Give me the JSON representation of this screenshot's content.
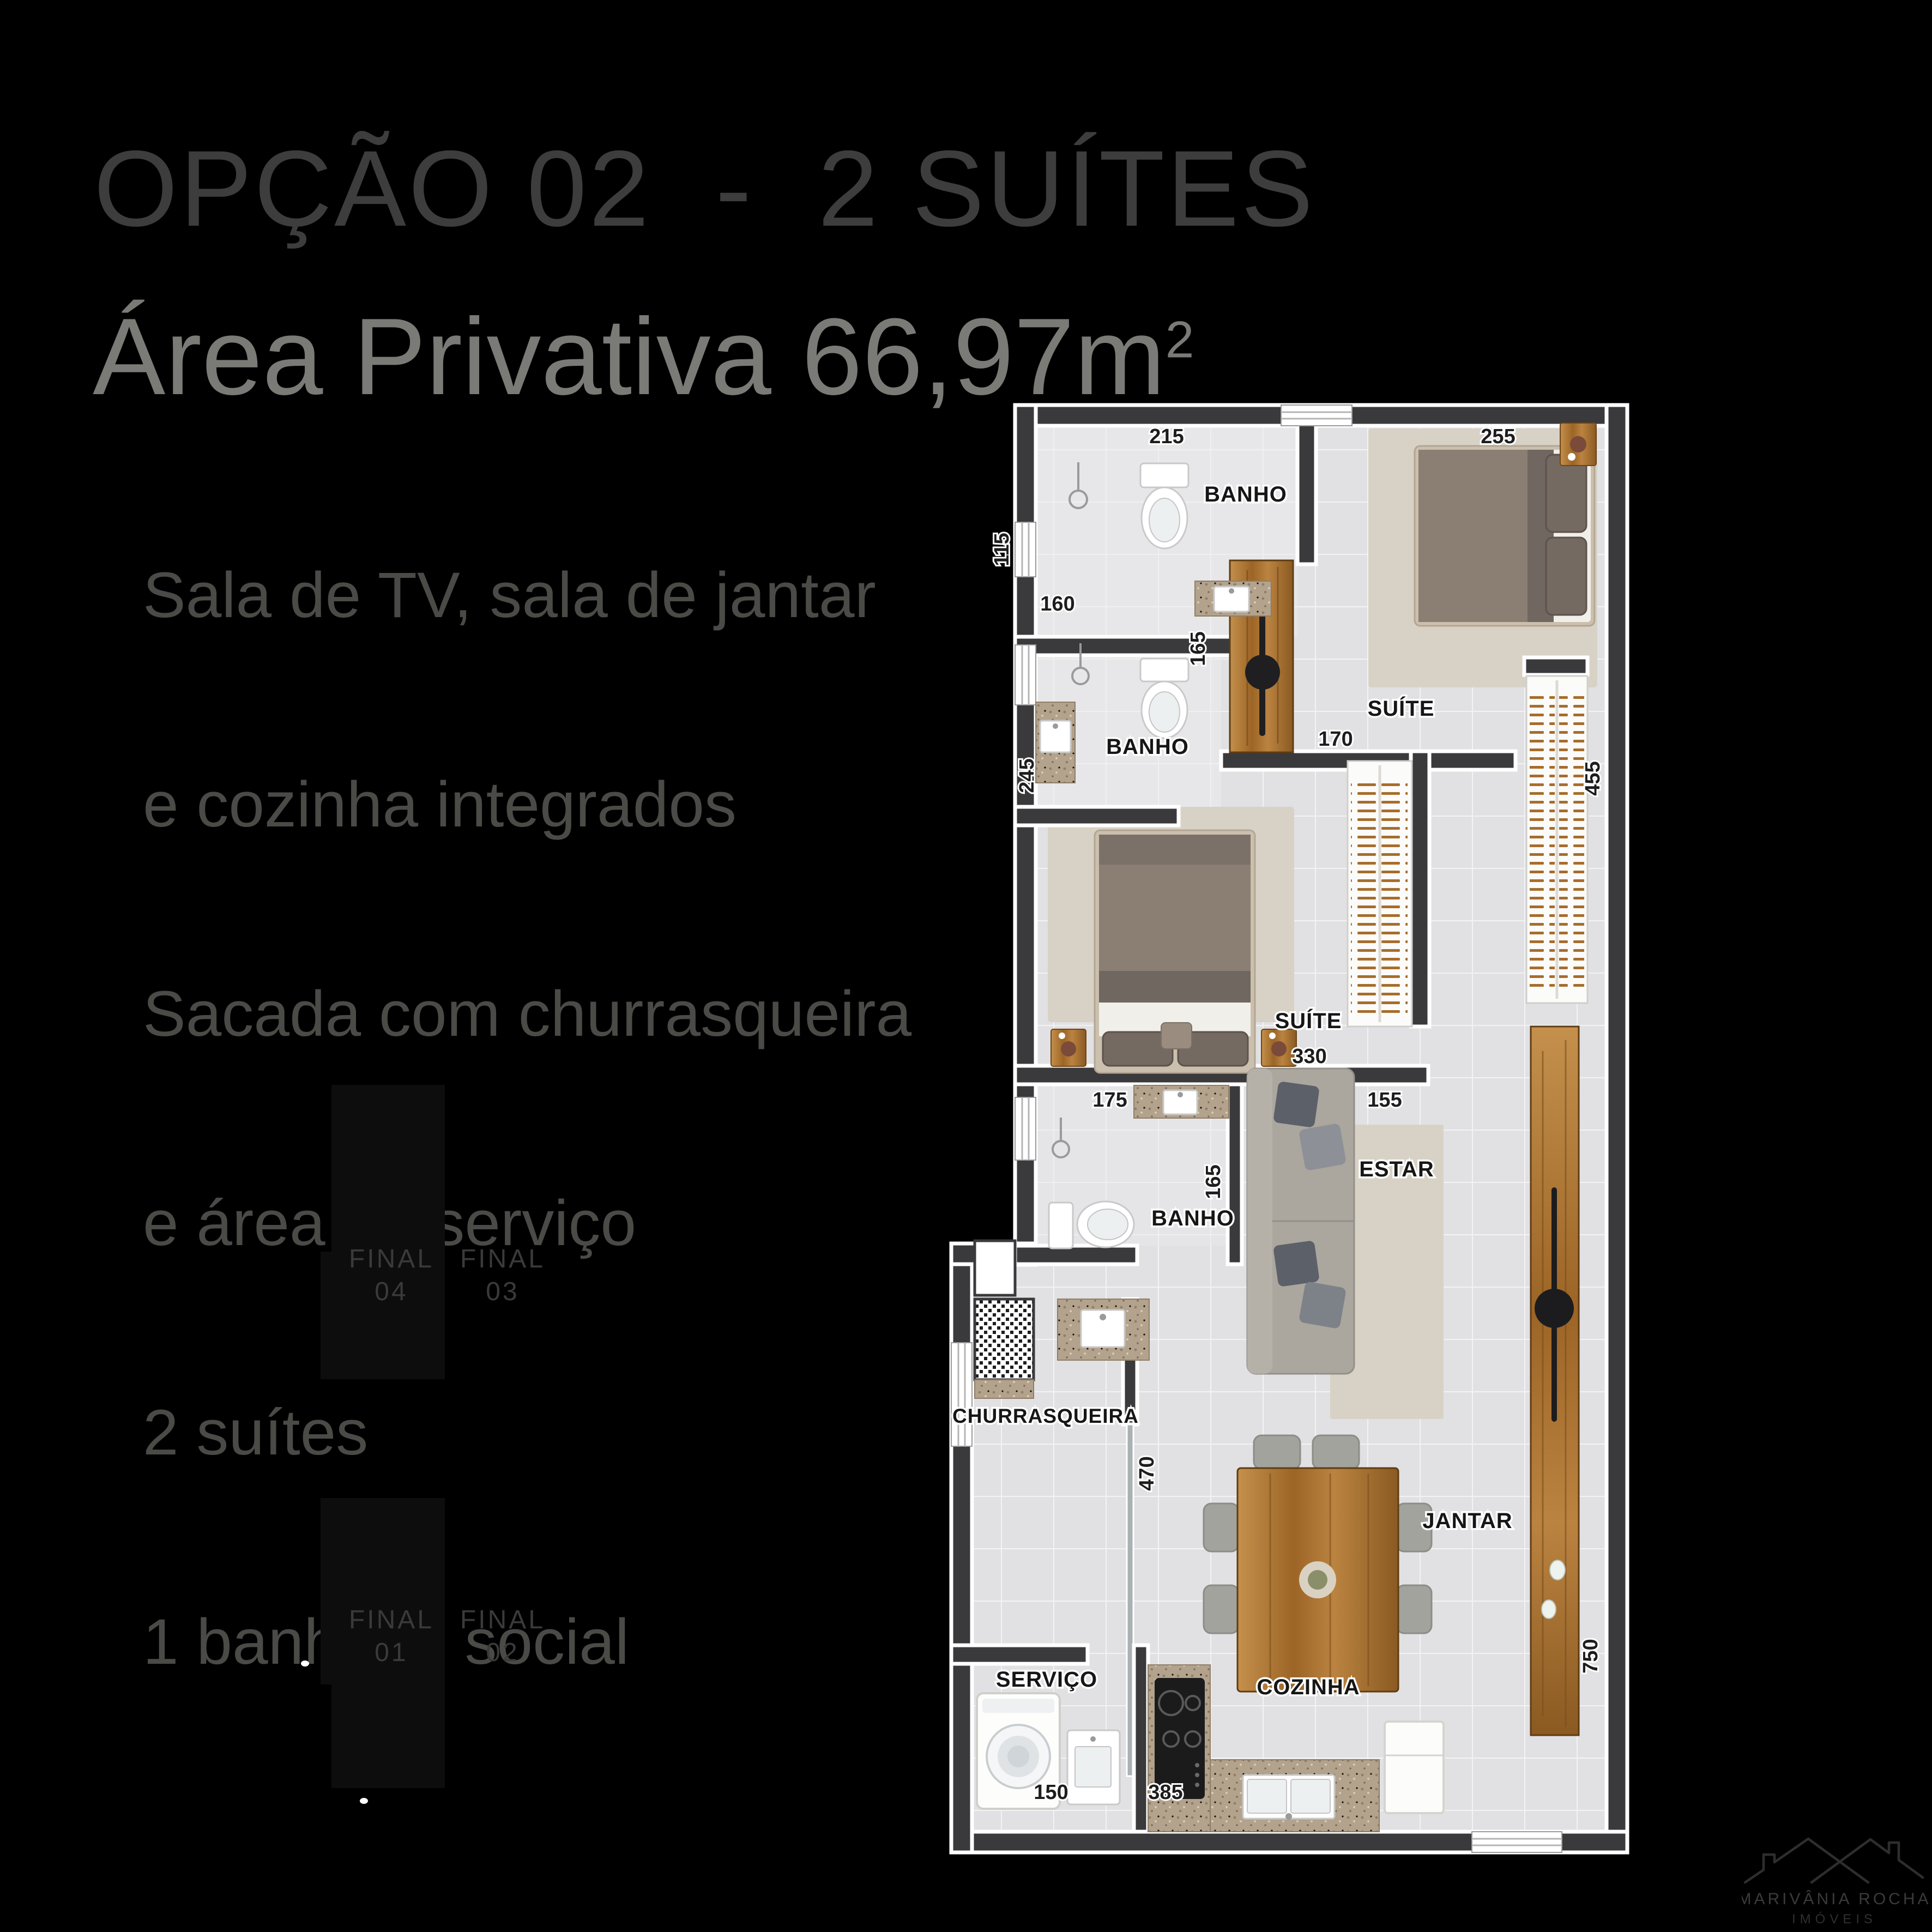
{
  "title": "OPÇÃO 02  -  2 SUÍTES",
  "area": {
    "label": "Área Privativa 66,97m",
    "sup": "2"
  },
  "features": [
    "Sala de TV, sala de jantar",
    "e cozinha integrados",
    "Sacada com churrasqueira",
    "e área de serviço",
    "2 suítes",
    "1 banheiro social"
  ],
  "plan": {
    "room_labels": {
      "banho_suite1": "BANHO",
      "suite1": "SUÍTE",
      "banho_suite2": "BANHO",
      "suite2": "SUÍTE",
      "estar": "ESTAR",
      "banho_social": "BANHO",
      "churrasqueira": "CHURRASQUEIRA",
      "jantar": "JANTAR",
      "servico": "SERVIÇO",
      "cozinha": "COZINHA"
    },
    "dimensions": {
      "banho1_width": "215",
      "suite1_width": "255",
      "janela_115": "115",
      "janela_160": "160",
      "banho1_depth": "165",
      "porta_suite1": "170",
      "closet_suite1": "455",
      "parede_245": "245",
      "suite2_width": "330",
      "banho3_175": "175",
      "estar_155": "155",
      "banho3_depth": "165",
      "sacada_470": "470",
      "sacada_750": "750",
      "servico_width": "150",
      "cozinha_width": "385"
    }
  },
  "keyplan": {
    "units": [
      {
        "label": "FINAL",
        "number": "04"
      },
      {
        "label": "FINAL",
        "number": "03"
      },
      {
        "label": "FINAL",
        "number": "01"
      },
      {
        "label": "FINAL",
        "number": "02"
      }
    ]
  },
  "logo": {
    "name": "MARIVÂNIA ROCHA",
    "subtitle": "IMÓVEIS"
  },
  "colors": {
    "background": "#000000",
    "wall": "#3a3a3c",
    "floor": "#e2e2e4",
    "wood": "#b5793a",
    "granite": "#b3a28c",
    "title_text": "#3d3d3d",
    "area_text": "#7a7a77",
    "feature_text": "#4a4a47"
  }
}
